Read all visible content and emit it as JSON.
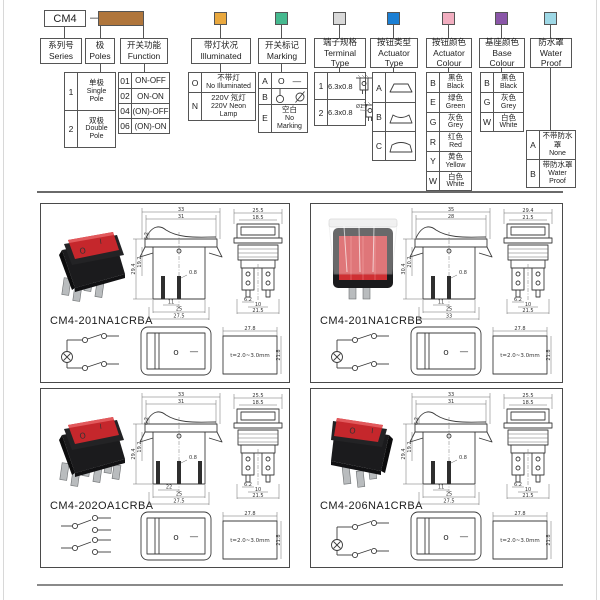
{
  "builder": {
    "series_box": "CM4",
    "dash": "—",
    "swatch_colors": {
      "poles_function": "#b0763c",
      "illuminated": "#e9a83e",
      "marking": "#46b98f",
      "terminal": "#d9d9d9",
      "actuator_type": "#1b7fd4",
      "actuator_colour": "#f2aec0",
      "base_colour": "#8a56a8",
      "water_proof": "#9ed8e6"
    },
    "series": {
      "zh": "系列号",
      "en": "Series"
    },
    "poles": {
      "zh": "极",
      "en": "Poles",
      "rows": [
        {
          "code": "1",
          "zh": "单极",
          "en1": "Single",
          "en2": "Pole"
        },
        {
          "code": "2",
          "zh": "双极",
          "en1": "Double",
          "en2": "Pole"
        }
      ]
    },
    "function": {
      "zh": "开关功能",
      "en": "Function",
      "rows": [
        {
          "code": "01",
          "label": "ON-OFF"
        },
        {
          "code": "02",
          "label": "ON-ON"
        },
        {
          "code": "04",
          "label": "(ON)-OFF"
        },
        {
          "code": "06",
          "label": "(ON)-ON"
        }
      ]
    },
    "illuminated": {
      "zh": "带灯状况",
      "en": "Illuminated",
      "rows": [
        {
          "code": "O",
          "zh": "不带灯",
          "en": "No Illuminated"
        },
        {
          "code": "N",
          "zh": "220V 氖灯",
          "en": "220V Neon Lamp"
        }
      ]
    },
    "marking": {
      "zh": "开关标记",
      "en": "Marking",
      "rows": [
        {
          "code": "A",
          "sym1": "O",
          "sym2": "—"
        },
        {
          "code": "B",
          "icons": "circle-line-symbols"
        },
        {
          "code": "E",
          "zh": "空白",
          "en": "No Marking"
        }
      ]
    },
    "terminal": {
      "zh": "端子规格",
      "en": "Terminal Type",
      "rows": [
        {
          "code": "1",
          "size": "6.3x0.8"
        },
        {
          "code": "2",
          "size": "6.3x0.8",
          "note": "Ø1.7"
        }
      ]
    },
    "actuator_type": {
      "zh": "按钮类型",
      "en": "Actuator Type",
      "rows": [
        {
          "code": "A",
          "icon": "rocker-flat"
        },
        {
          "code": "B",
          "icon": "rocker-concave"
        },
        {
          "code": "C",
          "icon": "rocker-convex"
        }
      ]
    },
    "actuator_colour": {
      "zh": "按钮颜色",
      "en": "Actuator Colour",
      "rows": [
        {
          "code": "B",
          "zh": "黑色",
          "en": "Black"
        },
        {
          "code": "E",
          "zh": "绿色",
          "en": "Green"
        },
        {
          "code": "G",
          "zh": "灰色",
          "en": "Grey"
        },
        {
          "code": "R",
          "zh": "红色",
          "en": "Red"
        },
        {
          "code": "Y",
          "zh": "黄色",
          "en": "Yellow"
        },
        {
          "code": "W",
          "zh": "白色",
          "en": "White"
        }
      ]
    },
    "base_colour": {
      "zh": "基座颜色",
      "en": "Base Colour",
      "rows": [
        {
          "code": "B",
          "zh": "黑色",
          "en": "Black"
        },
        {
          "code": "G",
          "zh": "灰色",
          "en": "Grey"
        },
        {
          "code": "W",
          "zh": "白色",
          "en": "White"
        }
      ]
    },
    "water_proof": {
      "zh": "防水罩",
      "en": "Water Proof",
      "rows": [
        {
          "code": "A",
          "zh": "不带防水罩",
          "en": "None"
        },
        {
          "code": "B",
          "zh": "带防水罩",
          "en": "Water Proof"
        }
      ]
    }
  },
  "products": [
    {
      "part_number": "CM4-201NA1CRBA",
      "photo": {
        "rocker": "#c5272c",
        "mark_on": "I",
        "mark_off": "O"
      },
      "front": {
        "w1": "33",
        "w2": "31",
        "h1": "29.4",
        "h2": "19.2",
        "h3": "6.2",
        "t": "0.8",
        "b1": "11",
        "b2": "25",
        "b3": "27.5"
      },
      "side": {
        "w1": "25.5",
        "w2": "18.5",
        "b1": "6.2",
        "b2": "10",
        "b3": "21.5"
      },
      "face": {
        "o": "o",
        "dash": "—"
      },
      "cutout": {
        "w": "27.8",
        "h": "21.8",
        "note": "t=2.0~3.0mm"
      }
    },
    {
      "part_number": "CM4-201NA1CRBB",
      "photo": {
        "rocker": "#cf2f33"
      },
      "front": {
        "w1": "35",
        "w2": "28",
        "h1": "30.4",
        "h2": "20.2",
        "h3": "",
        "t": "0.8",
        "b1": "11",
        "b2": "25",
        "b3": "33"
      },
      "side": {
        "w1": "29.4",
        "w2": "21.5",
        "b1": "6.2",
        "b2": "10",
        "b3": "21.5"
      },
      "face": {
        "o": "o",
        "dash": "—"
      },
      "cutout": {
        "w": "27.8",
        "h": "21.8",
        "note": "t=2.0~3.0mm"
      }
    },
    {
      "part_number": "CM4-202OA1CRBA",
      "photo": {
        "rocker": "#c5272c",
        "mark_on": "I",
        "mark_off": "O"
      },
      "front": {
        "w1": "33",
        "w2": "31",
        "h1": "29.4",
        "h2": "19.2",
        "h3": "6.2",
        "t": "0.8",
        "b1": "22",
        "b2": "25",
        "b3": "27.5"
      },
      "side": {
        "w1": "25.5",
        "w2": "18.5",
        "b1": "6.2",
        "b2": "10",
        "b3": "21.5"
      },
      "face": {
        "o": "o",
        "dash": "—"
      },
      "cutout": {
        "w": "27.8",
        "h": "21.8",
        "note": "t=2.0~3.0mm"
      }
    },
    {
      "part_number": "CM4-206NA1CRBA",
      "photo": {
        "rocker": "#c5272c",
        "mark_on": "I",
        "mark_off": "O"
      },
      "front": {
        "w1": "33",
        "w2": "31",
        "h1": "29.4",
        "h2": "19.2",
        "h3": "6.2",
        "t": "0.8",
        "b1": "11",
        "b2": "25",
        "b3": "27.5"
      },
      "side": {
        "w1": "25.5",
        "w2": "18.5",
        "b1": "6.2",
        "b2": "10",
        "b3": "21.5"
      },
      "face": {
        "o": "o",
        "dash": "—"
      },
      "cutout": {
        "w": "27.8",
        "h": "21.8",
        "note": "t=2.0~3.0mm"
      }
    }
  ]
}
